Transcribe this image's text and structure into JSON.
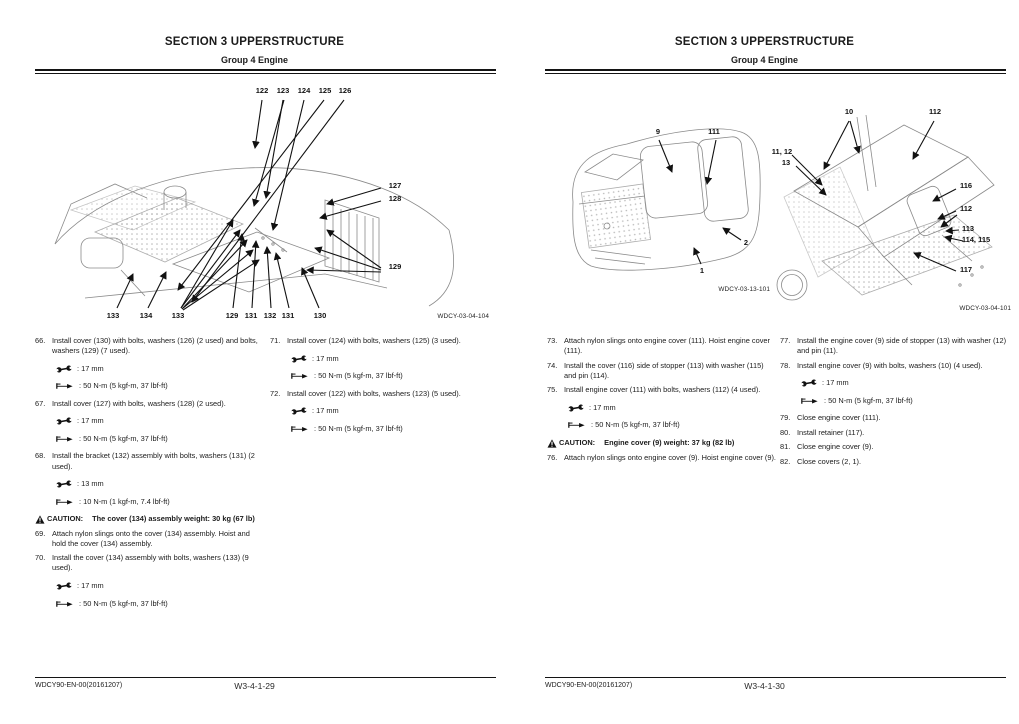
{
  "pages": [
    {
      "header": {
        "title": "SECTION 3 UPPERSTRUCTURE",
        "subtitle": "Group 4 Engine"
      },
      "figures": [
        {
          "id": "WDCY-03-04-104",
          "callouts": [
            {
              "label": "122",
              "x": 237,
              "y": 4
            },
            {
              "label": "123",
              "x": 258,
              "y": 4
            },
            {
              "label": "124",
              "x": 279,
              "y": 4
            },
            {
              "label": "125",
              "x": 300,
              "y": 4
            },
            {
              "label": "126",
              "x": 320,
              "y": 4
            },
            {
              "label": "127",
              "x": 370,
              "y": 99
            },
            {
              "label": "128",
              "x": 370,
              "y": 112
            },
            {
              "label": "129",
              "x": 370,
              "y": 180
            },
            {
              "label": "133",
              "x": 88,
              "y": 229
            },
            {
              "label": "134",
              "x": 121,
              "y": 229
            },
            {
              "label": "133",
              "x": 153,
              "y": 229
            },
            {
              "label": "129",
              "x": 207,
              "y": 229
            },
            {
              "label": "131",
              "x": 226,
              "y": 229
            },
            {
              "label": "132",
              "x": 245,
              "y": 229
            },
            {
              "label": "131",
              "x": 263,
              "y": 229
            },
            {
              "label": "130",
              "x": 295,
              "y": 229
            }
          ]
        }
      ],
      "columns": [
        {
          "blocks": [
            {
              "type": "step",
              "num": "66.",
              "text": "Install cover (130) with bolts, washers (126) (2 used) and bolts, washers (129) (7 used)."
            },
            {
              "type": "tool",
              "icon": "wrench-icon",
              "text": ": 17 mm"
            },
            {
              "type": "tool",
              "icon": "torque-wrench-icon",
              "text": ": 50 N-m (5 kgf-m, 37 lbf-ft)"
            },
            {
              "type": "step",
              "num": "67.",
              "text": "Install cover (127) with bolts, washers (128) (2 used)."
            },
            {
              "type": "tool",
              "icon": "wrench-icon",
              "text": ": 17 mm"
            },
            {
              "type": "tool",
              "icon": "torque-wrench-icon",
              "text": ": 50 N-m (5 kgf-m, 37 lbf-ft)"
            },
            {
              "type": "step",
              "num": "68.",
              "text": "Install the bracket (132) assembly with bolts, washers (131) (2 used)."
            },
            {
              "type": "tool",
              "icon": "wrench-icon",
              "text": ": 13 mm"
            },
            {
              "type": "tool",
              "icon": "torque-wrench-icon",
              "text": ": 10 N-m (1 kgf-m, 7.4 lbf-ft)"
            },
            {
              "type": "caution",
              "label": "CAUTION:",
              "text": "The cover (134) assembly weight: 30 kg (67 lb)"
            },
            {
              "type": "step",
              "num": "69.",
              "text": "Attach nylon slings onto the cover (134) assembly. Hoist and hold the cover (134) assembly."
            },
            {
              "type": "step",
              "num": "70.",
              "text": "Install the cover (134) assembly with bolts, washers (133) (9 used)."
            },
            {
              "type": "tool",
              "icon": "wrench-icon",
              "text": ": 17 mm"
            },
            {
              "type": "tool",
              "icon": "torque-wrench-icon",
              "text": ": 50 N-m (5 kgf-m, 37 lbf-ft)"
            }
          ]
        },
        {
          "blocks": [
            {
              "type": "step",
              "num": "71.",
              "text": "Install cover (124) with bolts, washers (125) (3 used)."
            },
            {
              "type": "tool",
              "icon": "wrench-icon",
              "text": ": 17 mm"
            },
            {
              "type": "tool",
              "icon": "torque-wrench-icon",
              "text": ": 50 N-m (5 kgf-m, 37 lbf-ft)"
            },
            {
              "type": "step",
              "num": "72.",
              "text": "Install cover (122) with bolts, washers (123) (5 used)."
            },
            {
              "type": "tool",
              "icon": "wrench-icon",
              "text": ": 17 mm"
            },
            {
              "type": "tool",
              "icon": "torque-wrench-icon",
              "text": ": 50 N-m (5 kgf-m, 37 lbf-ft)"
            }
          ]
        }
      ],
      "footer": {
        "doc_code": "WDCY90-EN-00(20161207)",
        "page_number": "W3-4-1-29"
      }
    },
    {
      "header": {
        "title": "SECTION 3 UPPERSTRUCTURE",
        "subtitle": "Group 4 Engine"
      },
      "figures": [
        {
          "id": "WDCY-03-13-101",
          "callouts": [
            {
              "label": "9",
              "x": 103,
              "y": 27
            },
            {
              "label": "111",
              "x": 159,
              "y": 27
            },
            {
              "label": "2",
              "x": 191,
              "y": 138
            },
            {
              "label": "1",
              "x": 147,
              "y": 166
            }
          ]
        },
        {
          "id": "WDCY-03-04-101",
          "callouts": [
            {
              "label": "10",
              "x": 87,
              "y": 12
            },
            {
              "label": "112",
              "x": 173,
              "y": 12
            },
            {
              "label": "11, 12",
              "x": 20,
              "y": 52
            },
            {
              "label": "13",
              "x": 24,
              "y": 63
            },
            {
              "label": "116",
              "x": 204,
              "y": 86
            },
            {
              "label": "112",
              "x": 204,
              "y": 109
            },
            {
              "label": "113",
              "x": 206,
              "y": 129
            },
            {
              "label": "114, 115",
              "x": 214,
              "y": 140
            },
            {
              "label": "117",
              "x": 204,
              "y": 170
            }
          ]
        }
      ],
      "columns": [
        {
          "blocks": [
            {
              "type": "step",
              "num": "73.",
              "text": "Attach nylon slings onto engine cover (111). Hoist engine cover (111)."
            },
            {
              "type": "step",
              "num": "74.",
              "text": "Install the cover (116) side of stopper (113) with washer (115) and pin (114)."
            },
            {
              "type": "step",
              "num": "75.",
              "text": "Install engine cover (111) with bolts, washers (112) (4 used)."
            },
            {
              "type": "tool",
              "icon": "wrench-icon",
              "text": ": 17 mm"
            },
            {
              "type": "tool",
              "icon": "torque-wrench-icon",
              "text": ": 50 N-m (5 kgf-m, 37 lbf-ft)"
            },
            {
              "type": "caution",
              "label": "CAUTION:",
              "text": "Engine cover (9) weight: 37 kg (82 lb)"
            },
            {
              "type": "step",
              "num": "76.",
              "text": "Attach nylon slings onto engine cover (9). Hoist engine cover (9)."
            }
          ]
        },
        {
          "blocks": [
            {
              "type": "step",
              "num": "77.",
              "text": "Install the engine cover (9) side of stopper (13) with washer (12) and pin (11)."
            },
            {
              "type": "step",
              "num": "78.",
              "text": "Install engine cover (9) with bolts, washers (10) (4 used)."
            },
            {
              "type": "tool",
              "icon": "wrench-icon",
              "text": ": 17 mm"
            },
            {
              "type": "tool",
              "icon": "torque-wrench-icon",
              "text": ": 50 N-m (5 kgf-m, 37 lbf-ft)"
            },
            {
              "type": "step",
              "num": "79.",
              "text": "Close engine cover (111)."
            },
            {
              "type": "step",
              "num": "80.",
              "text": "Install retainer (117)."
            },
            {
              "type": "step",
              "num": "81.",
              "text": "Close engine cover (9)."
            },
            {
              "type": "step",
              "num": "82.",
              "text": "Close covers (2, 1)."
            }
          ]
        }
      ],
      "footer": {
        "doc_code": "WDCY90-EN-00(20161207)",
        "page_number": "W3-4-1-30"
      }
    }
  ],
  "colors": {
    "text": "#1b1b1b",
    "line": "#141414",
    "sketch": "#8a8a8a"
  }
}
